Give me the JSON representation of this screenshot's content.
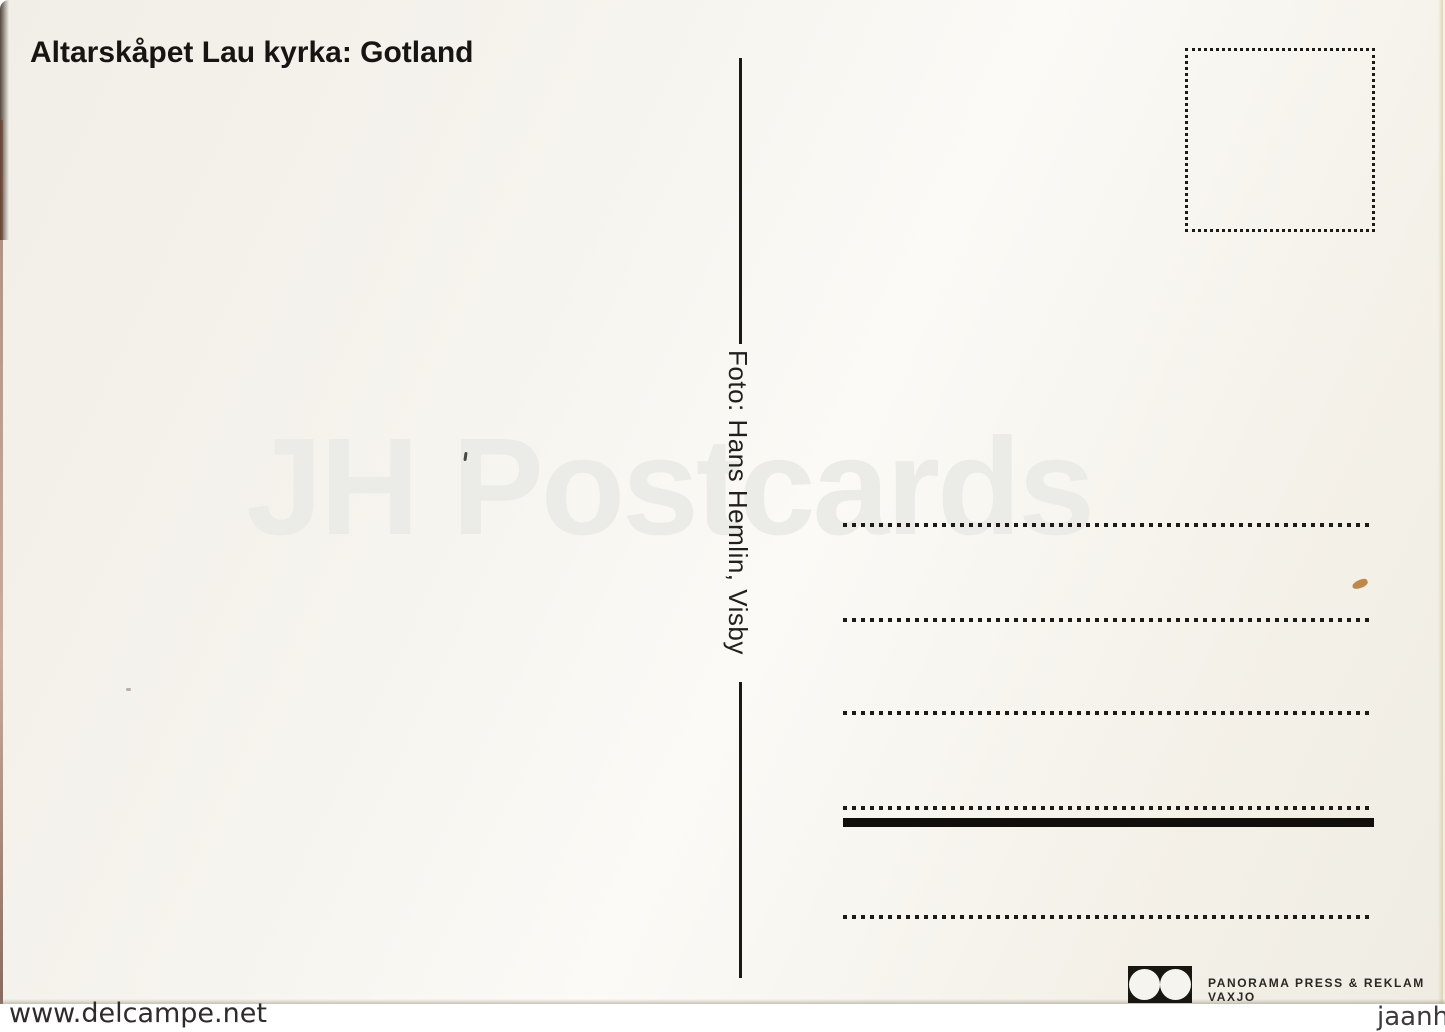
{
  "postcard": {
    "title": "Altarskåpet Lau kyrka: Gotland",
    "photo_credit": "Foto: Hans Hemlin, Visby",
    "publisher": {
      "name": "PANORAMA PRESS & REKLAM VAXJO",
      "logo_icon": "two-white-circles-in-black-rectangle"
    },
    "stamp_box": "empty dotted square for postage stamp",
    "address_lines_count": 5
  },
  "watermarks": {
    "center": "JH Postcards",
    "bottom_left": "www.delcampe.net",
    "bottom_right": "jaanhus"
  },
  "colors": {
    "card_background": "#f3f1ea",
    "ink": "#1d1b16",
    "center_watermark": "#ebebe8",
    "stain": "#b5762f"
  }
}
